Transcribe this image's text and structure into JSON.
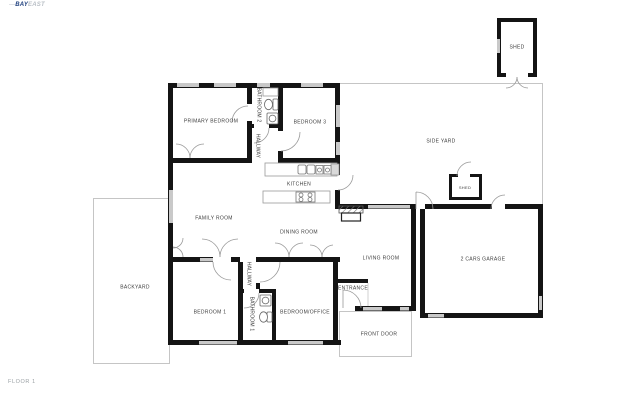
{
  "logo": {
    "prefix": "—",
    "primary": "BAY",
    "secondary": "EAST"
  },
  "floor_label": "FLOOR 1",
  "colors": {
    "wall": "#141414",
    "window": "#c9c9c9",
    "door_arc": "#9a9a9a",
    "yard_line": "#c5c5c5",
    "label_text": "#3d3d3d",
    "logo_primary": "#1c3d7c",
    "logo_secondary": "#b9bfc6"
  },
  "rooms": {
    "primary_bedroom": "PRIMARY BEDROOM",
    "bathroom_2": "BATHROOM 2",
    "hallway_upper": "HALLWAY",
    "bedroom_3": "BEDROOM 3",
    "kitchen": "KITCHEN",
    "family_room": "FAMILY ROOM",
    "dining_room": "DINING ROOM",
    "living_room": "LIVING ROOM",
    "entrance": "ENTRANCE",
    "front_door": "FRONT DOOR",
    "garage": "2 CARS GARAGE",
    "side_yard": "SIDE YARD",
    "shed_upper": "SHED",
    "shed_lower": "SHED",
    "backyard": "BACKYARD",
    "bedroom_1": "BEDROOM 1",
    "bathroom_1": "BATHROOM 1",
    "hallway_lower": "HALLWAY",
    "bedroom_office": "BEDROOM/OFFICE"
  }
}
